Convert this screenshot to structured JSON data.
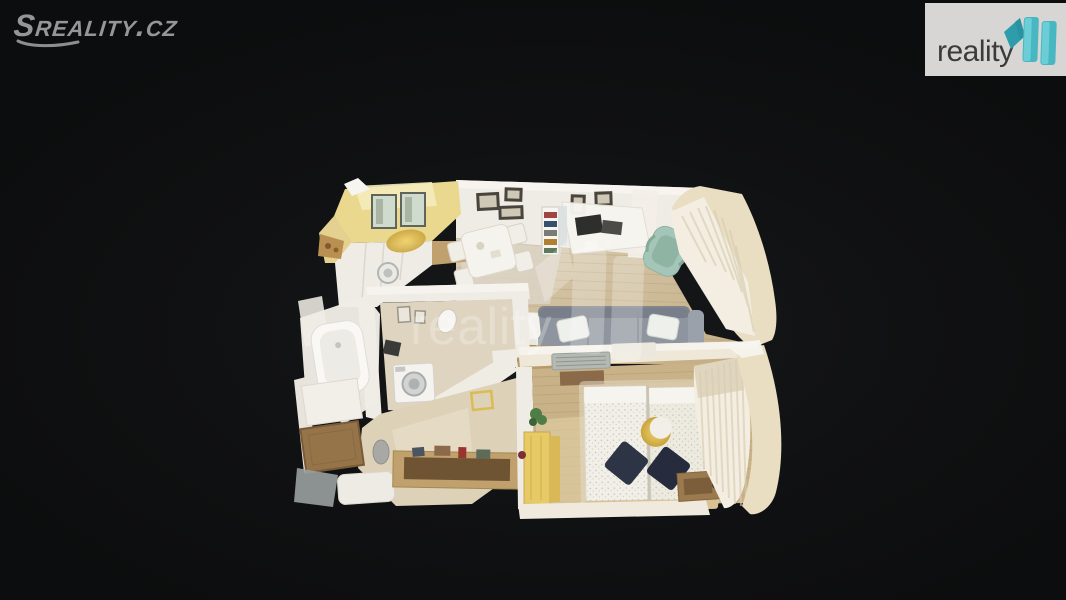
{
  "header": {
    "sreality_logo": {
      "text": "Sreality.cz"
    },
    "reality11_logo": {
      "text": "reality"
    }
  },
  "watermark": {
    "text": "reality",
    "opacity": "0.25"
  },
  "floorplan": {
    "view": "3d-dollhouse-top-down-apartment-scan",
    "rooms": [
      "kitchen",
      "dining-area",
      "living-room",
      "bathroom",
      "hallway",
      "bedroom"
    ],
    "furnishings": [
      "kitchen-cabinets",
      "sink",
      "dining-table",
      "bookshelf",
      "desk",
      "office-chair",
      "sofa",
      "coffee-bench",
      "bathtub",
      "washing-machine",
      "entry-door",
      "console-table",
      "double-bed",
      "navy-pillows",
      "gold-wall-decor",
      "wardrobe",
      "curtains",
      "air-conditioner",
      "plant"
    ]
  },
  "palette": {
    "bg": "#101112",
    "sreality_grey": "#969696",
    "badge_bg": "#d7d6d4",
    "badge_text": "#3b3b3b",
    "teal_light": "#6fd0d8",
    "teal": "#49b7c2",
    "teal_dark": "#2d9dac",
    "wall_white": "#efece6",
    "wall_bright": "#f7f5f0",
    "wall_cream": "#e9ddc2",
    "wall_yellow": "#e9d88e",
    "wall_yellow_light": "#f4ecbc",
    "floor_wood": "#d3c2a2",
    "floor_wood_dark": "#c3ae86",
    "floor_tile": "#dcd3c6",
    "floor_bedroom": "#c9b288",
    "bath_floor": "#ded4c0",
    "sofa_grey": "#8f959e",
    "sofa_grey_dark": "#747b86",
    "pillow_white": "#eef0ec",
    "chair_teal": "#a3c6b8",
    "wood_mid": "#c0a06c",
    "wood_dark": "#6f5433",
    "door_brown": "#96744a",
    "bed_white": "#f1efe8",
    "pillow_navy": "#2d3446",
    "gold": "#d6b65a",
    "wardrobe_yellow": "#e7c965",
    "curtain": "#f3eee1",
    "curtain_shadow": "#d8cdb2",
    "appliance": "#f4f3f0",
    "dark_item": "#3a3a38",
    "frame_dark": "#4a453c",
    "glass_green": "#cfdccd",
    "grey_step": "#9aa0a1",
    "plant_green": "#4e7d46",
    "watermark_white": "#ffffff"
  }
}
